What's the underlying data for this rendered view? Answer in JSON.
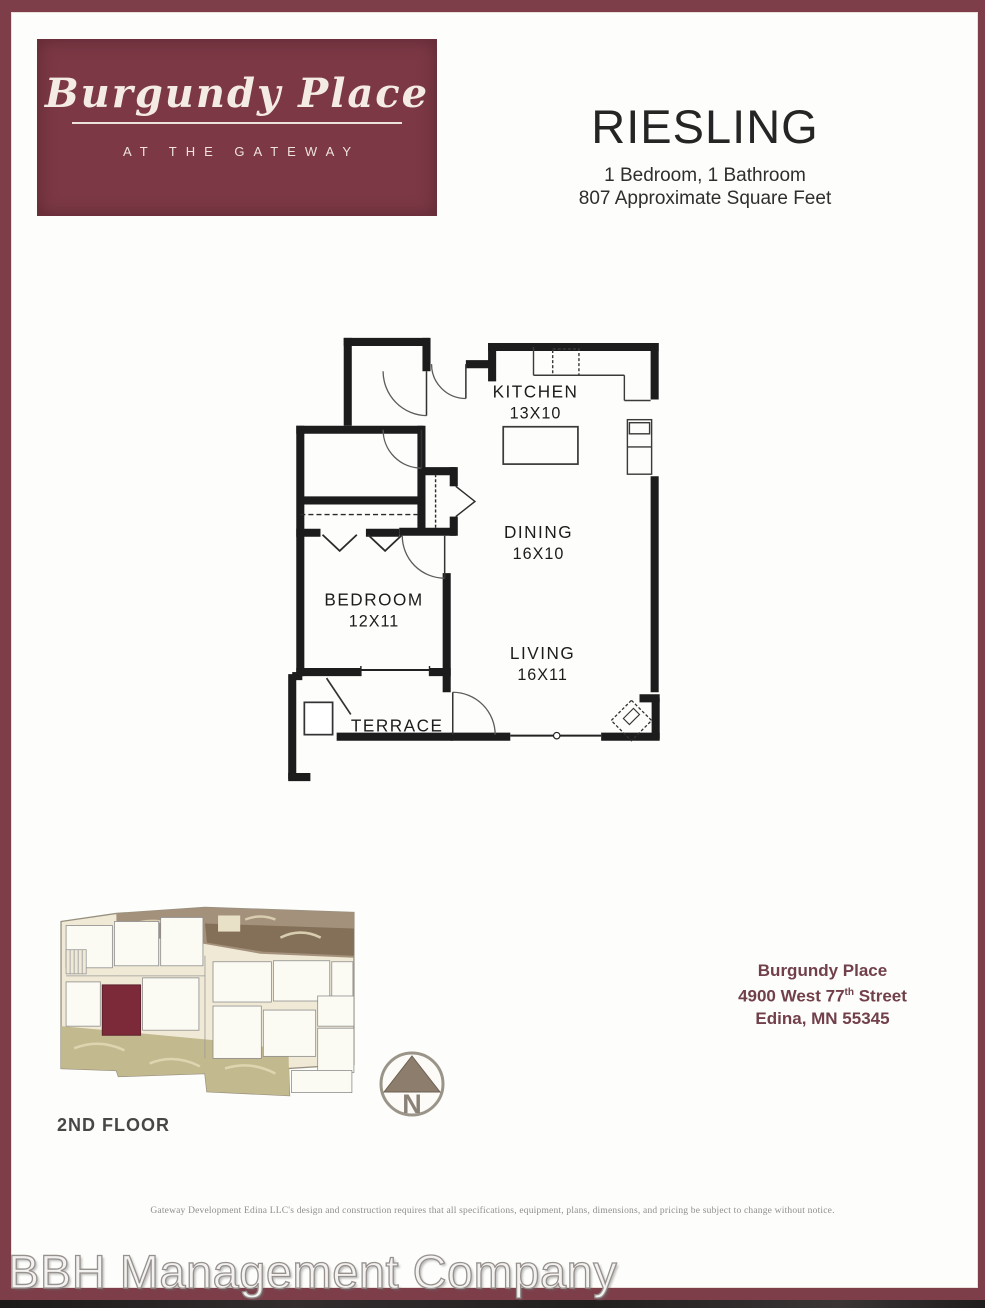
{
  "branding": {
    "name_script": "Burgundy Place",
    "tagline": "AT THE GATEWAY"
  },
  "unit": {
    "name": "RIESLING",
    "beds_baths": "1 Bedroom, 1 Bathroom",
    "sqft": "807 Approximate Square Feet"
  },
  "floorplan": {
    "rooms": [
      {
        "label": "KITCHEN",
        "dims": "13X10"
      },
      {
        "label": "DINING",
        "dims": "16X10"
      },
      {
        "label": "BEDROOM",
        "dims": "12X11"
      },
      {
        "label": "LIVING",
        "dims": "16X11"
      },
      {
        "label": "TERRACE",
        "dims": ""
      }
    ]
  },
  "siteplan": {
    "floor_label": "2ND FLOOR",
    "compass_letter": "N"
  },
  "address": {
    "line1": "Burgundy Place",
    "line2_prefix": "4900 West 77",
    "line2_sup": "th",
    "line2_suffix": " Street",
    "line3": "Edina, MN 55345"
  },
  "disclaimer": "Gateway Development Edina LLC's design and construction requires that all specifications, equipment, plans, dimensions, and pricing be subject to change without notice.",
  "footer": "BBH Management Company",
  "colors": {
    "frame_burgundy": "#7d3e49",
    "logo_burgundy": "#7c3945",
    "unit_highlight": "#7c2a39",
    "address_maroon": "#71404b"
  }
}
